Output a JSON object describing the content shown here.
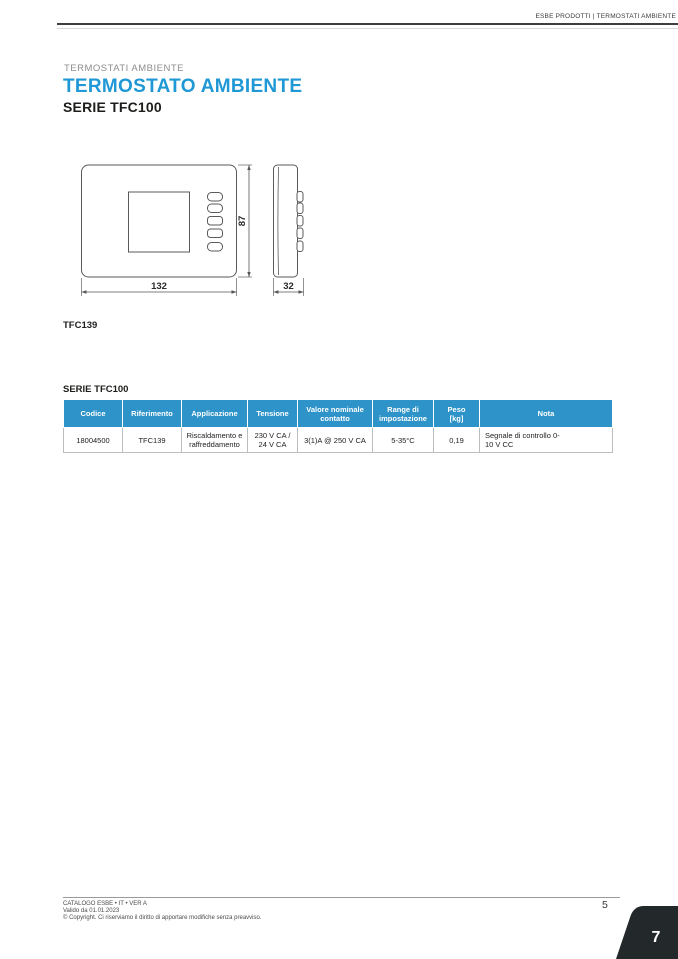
{
  "page": {
    "breadcrumb": "ESBE PRODOTTI | TERMOSTATI AMBIENTE"
  },
  "title": {
    "eyebrow": "TERMOSTATI AMBIENTE",
    "heading": "TERMOSTATO AMBIENTE",
    "series": "SERIE TFC100"
  },
  "diagram": {
    "model": "TFC139",
    "width_mm": "132",
    "height_mm": "87",
    "depth_mm": "32"
  },
  "table": {
    "caption": "SERIE TFC100",
    "headers": [
      "Codice",
      "Riferimento",
      "Applicazione",
      "Tensione",
      "Valore nominale contatto",
      "Range di impostazione",
      "Peso [kg]",
      "Nota"
    ],
    "rows": [
      [
        "18004500",
        "TFC139",
        "Riscaldamento e raffreddamento",
        "230 V CA / 24 V CA",
        "3(1)A @ 250 V CA",
        "5-35°C",
        "0,19",
        "Segnale di controllo 0-10 V CC"
      ]
    ]
  },
  "footer": {
    "catalog": "CATALOGO ESBE • IT • VER A",
    "valid": "Valido da 01.01.2023",
    "copyright": "© Copyright. Ci riserviamo il diritto di apportare modifiche senza preavviso.",
    "page_number": "5",
    "chapter_tab": "7"
  },
  "colors": {
    "accent_blue": "#1f98d5",
    "table_header_blue": "#2e93c9",
    "tab_dark": "#23282a"
  }
}
